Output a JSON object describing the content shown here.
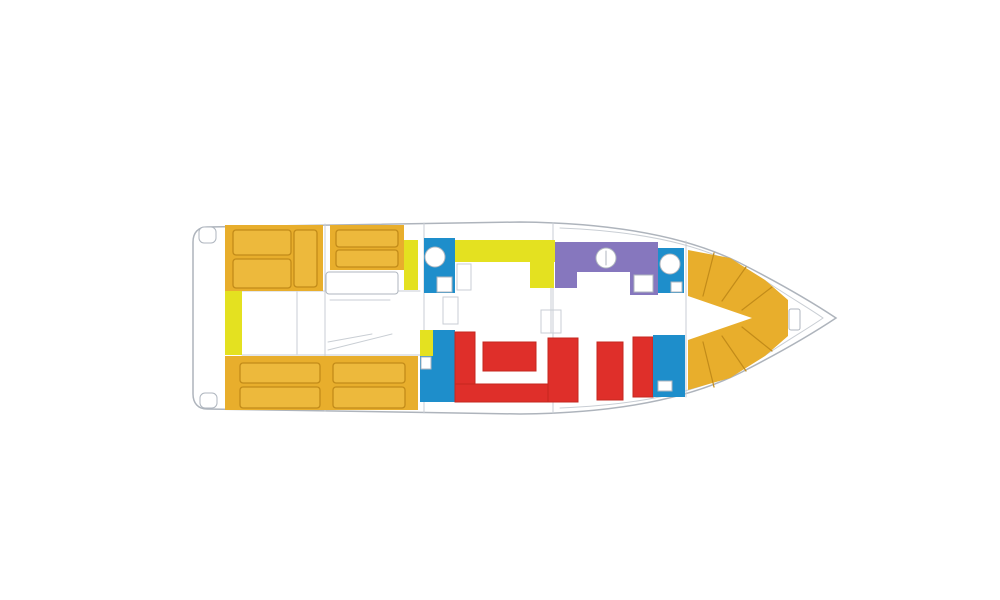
{
  "canvas": {
    "width": 1000,
    "height": 600,
    "background": "#FFFFFF"
  },
  "palette": {
    "white": "#FFFFFF",
    "amber": "#E8AE2C",
    "amber_light": "#EDB93C",
    "amber_stroke": "#C28B19",
    "lemon": "#E4E120",
    "blue": "#1E8ECB",
    "purple": "#8677BE",
    "red": "#DF2F2A",
    "red_stroke": "#C4271F",
    "hull_stroke": "#AEB4BC",
    "detail_stroke": "#AFB6BF",
    "detail_light": "#C9CED4"
  },
  "shapes": [
    {
      "type": "path",
      "name": "hull-outline",
      "d": "M207,227 L520,222 C620,223 690,238 740,263 C785,286 818,306 836,318 C818,330 785,350 740,373 C690,398 620,413 520,414 L207,409 C198,409 193,403 193,394 L193,242 C193,233 198,227 207,227 Z",
      "fill": "white",
      "stroke": "hull_stroke",
      "sw": 1.5
    },
    {
      "type": "path",
      "name": "hull-inner-line",
      "d": "M560,228 C660,232 716,250 761,278 C791,298 812,310 823,318 C812,326 791,338 761,358 C716,386 660,404 560,408",
      "fill": "none",
      "stroke": "detail_light",
      "sw": 1
    },
    {
      "type": "rect",
      "name": "stern-step-top",
      "x": 199,
      "y": 227,
      "w": 17,
      "h": 16,
      "rx": 5,
      "fill": "white",
      "stroke": "detail_stroke",
      "sw": 1
    },
    {
      "type": "rect",
      "name": "stern-step-bottom",
      "x": 200,
      "y": 393,
      "w": 17,
      "h": 15,
      "rx": 5,
      "fill": "white",
      "stroke": "detail_stroke",
      "sw": 1
    },
    {
      "type": "line",
      "name": "bulkhead-line",
      "x1": 325,
      "y1": 224,
      "x2": 325,
      "y2": 411,
      "stroke": "detail_light",
      "sw": 1
    },
    {
      "type": "line",
      "name": "bulkhead-line",
      "x1": 424,
      "y1": 223,
      "x2": 424,
      "y2": 413,
      "stroke": "detail_light",
      "sw": 1
    },
    {
      "type": "line",
      "name": "bulkhead-line",
      "x1": 553,
      "y1": 223,
      "x2": 553,
      "y2": 413,
      "stroke": "detail_light",
      "sw": 1
    },
    {
      "type": "line",
      "name": "bulkhead-line",
      "x1": 686,
      "y1": 241,
      "x2": 686,
      "y2": 397,
      "stroke": "detail_light",
      "sw": 1
    },
    {
      "type": "line",
      "name": "walkway-line",
      "x1": 242,
      "y1": 291,
      "x2": 420,
      "y2": 291,
      "stroke": "detail_light",
      "sw": 1
    },
    {
      "type": "line",
      "name": "walkway-line",
      "x1": 242,
      "y1": 355,
      "x2": 420,
      "y2": 355,
      "stroke": "detail_light",
      "sw": 1
    },
    {
      "type": "line",
      "name": "companionway-line",
      "x1": 297,
      "y1": 292,
      "x2": 297,
      "y2": 354,
      "stroke": "detail_light",
      "sw": 1
    },
    {
      "type": "rect",
      "name": "aft-sunpad-port",
      "x": 225,
      "y": 225,
      "w": 98,
      "h": 66,
      "fill": "amber"
    },
    {
      "type": "rect",
      "name": "aft-sunpad-mid",
      "x": 330,
      "y": 225,
      "w": 74,
      "h": 45,
      "fill": "amber"
    },
    {
      "type": "rect",
      "name": "aft-sunpad-starboard",
      "x": 225,
      "y": 356,
      "w": 193,
      "h": 54,
      "fill": "amber"
    },
    {
      "type": "rect",
      "name": "sunpad-cushion",
      "x": 233,
      "y": 230,
      "w": 58,
      "h": 25,
      "rx": 3,
      "fill": "amber_light",
      "stroke": "amber_stroke",
      "sw": 1.3
    },
    {
      "type": "rect",
      "name": "sunpad-cushion",
      "x": 233,
      "y": 259,
      "w": 58,
      "h": 29,
      "rx": 3,
      "fill": "amber_light",
      "stroke": "amber_stroke",
      "sw": 1.3
    },
    {
      "type": "rect",
      "name": "sunpad-cushion",
      "x": 294,
      "y": 230,
      "w": 23,
      "h": 57,
      "rx": 3,
      "fill": "amber_light",
      "stroke": "amber_stroke",
      "sw": 1.3
    },
    {
      "type": "rect",
      "name": "sunpad-cushion",
      "x": 336,
      "y": 230,
      "w": 62,
      "h": 17,
      "rx": 3,
      "fill": "amber_light",
      "stroke": "amber_stroke",
      "sw": 1.3
    },
    {
      "type": "rect",
      "name": "sunpad-cushion",
      "x": 336,
      "y": 250,
      "w": 62,
      "h": 17,
      "rx": 3,
      "fill": "amber_light",
      "stroke": "amber_stroke",
      "sw": 1.3
    },
    {
      "type": "rect",
      "name": "sunpad-cushion",
      "x": 240,
      "y": 363,
      "w": 80,
      "h": 20,
      "rx": 3,
      "fill": "amber_light",
      "stroke": "amber_stroke",
      "sw": 1.3
    },
    {
      "type": "rect",
      "name": "sunpad-cushion",
      "x": 240,
      "y": 387,
      "w": 80,
      "h": 21,
      "rx": 3,
      "fill": "amber_light",
      "stroke": "amber_stroke",
      "sw": 1.3
    },
    {
      "type": "rect",
      "name": "sunpad-cushion",
      "x": 333,
      "y": 363,
      "w": 72,
      "h": 20,
      "rx": 3,
      "fill": "amber_light",
      "stroke": "amber_stroke",
      "sw": 1.3
    },
    {
      "type": "rect",
      "name": "sunpad-cushion",
      "x": 333,
      "y": 387,
      "w": 72,
      "h": 21,
      "rx": 3,
      "fill": "amber_light",
      "stroke": "amber_stroke",
      "sw": 1.3
    },
    {
      "type": "rect",
      "name": "side-counter-strip",
      "x": 225,
      "y": 291,
      "w": 17,
      "h": 64,
      "fill": "lemon"
    },
    {
      "type": "rect",
      "name": "counter-strip-mid",
      "x": 404,
      "y": 240,
      "w": 14,
      "h": 50,
      "fill": "lemon"
    },
    {
      "type": "rect",
      "name": "berth-outline",
      "x": 326,
      "y": 272,
      "w": 72,
      "h": 22,
      "rx": 3,
      "fill": "white",
      "stroke": "detail_stroke",
      "sw": 1
    },
    {
      "type": "line",
      "name": "berth-line",
      "x1": 330,
      "y1": 300,
      "x2": 390,
      "y2": 300,
      "stroke": "detail_light",
      "sw": 1
    },
    {
      "type": "line",
      "name": "stair-line",
      "x1": 328,
      "y1": 350,
      "x2": 392,
      "y2": 334,
      "stroke": "detail_light",
      "sw": 1
    },
    {
      "type": "line",
      "name": "stair-line",
      "x1": 328,
      "y1": 342,
      "x2": 372,
      "y2": 334,
      "stroke": "detail_light",
      "sw": 1
    },
    {
      "type": "rect",
      "name": "wet-unit-top",
      "x": 424,
      "y": 238,
      "w": 31,
      "h": 55,
      "fill": "blue"
    },
    {
      "type": "circle",
      "name": "sink-basin",
      "cx": 435,
      "cy": 257,
      "r": 10,
      "fill": "white",
      "stroke": "detail_stroke",
      "sw": 1
    },
    {
      "type": "rect",
      "name": "fixture",
      "x": 437,
      "y": 277,
      "w": 15,
      "h": 15,
      "fill": "white",
      "stroke": "detail_stroke",
      "sw": 1
    },
    {
      "type": "rect",
      "name": "cabinet-outline",
      "x": 457,
      "y": 264,
      "w": 14,
      "h": 26,
      "fill": "none",
      "stroke": "detail_light",
      "sw": 1
    },
    {
      "type": "rect",
      "name": "galley-counter",
      "x": 455,
      "y": 240,
      "w": 100,
      "h": 22,
      "fill": "lemon"
    },
    {
      "type": "rect",
      "name": "galley-counter-return",
      "x": 530,
      "y": 262,
      "w": 24,
      "h": 26,
      "fill": "lemon"
    },
    {
      "type": "rect",
      "name": "helm-station",
      "x": 555,
      "y": 242,
      "w": 103,
      "h": 30,
      "fill": "purple"
    },
    {
      "type": "rect",
      "name": "helm-station-left",
      "x": 555,
      "y": 272,
      "w": 22,
      "h": 16,
      "fill": "purple"
    },
    {
      "type": "rect",
      "name": "helm-station-right",
      "x": 630,
      "y": 272,
      "w": 28,
      "h": 23,
      "fill": "purple"
    },
    {
      "type": "circle",
      "name": "helm-wheel",
      "cx": 606,
      "cy": 258,
      "r": 10,
      "fill": "white",
      "stroke": "detail_stroke",
      "sw": 1
    },
    {
      "type": "line",
      "name": "helm-wheel-mark",
      "x1": 606,
      "y1": 251,
      "x2": 606,
      "y2": 265,
      "stroke": "detail_stroke",
      "sw": 1
    },
    {
      "type": "rect",
      "name": "nav-table",
      "x": 634,
      "y": 275,
      "w": 19,
      "h": 17,
      "fill": "white",
      "stroke": "detail_stroke",
      "sw": 1
    },
    {
      "type": "rect",
      "name": "wet-unit-bow",
      "x": 658,
      "y": 248,
      "w": 26,
      "h": 45,
      "fill": "blue"
    },
    {
      "type": "circle",
      "name": "sink-basin-bow",
      "cx": 670,
      "cy": 264,
      "r": 10,
      "fill": "white",
      "stroke": "detail_stroke",
      "sw": 1
    },
    {
      "type": "rect",
      "name": "fixture-bow",
      "x": 671,
      "y": 282,
      "w": 11,
      "h": 10,
      "fill": "white",
      "stroke": "detail_stroke",
      "sw": 1
    },
    {
      "type": "rect",
      "name": "door-outline",
      "x": 443,
      "y": 297,
      "w": 15,
      "h": 27,
      "fill": "none",
      "stroke": "detail_light",
      "sw": 1
    },
    {
      "type": "rect",
      "name": "door-outline",
      "x": 541,
      "y": 310,
      "w": 20,
      "h": 23,
      "fill": "none",
      "stroke": "detail_light",
      "sw": 1
    },
    {
      "type": "line",
      "name": "door-line",
      "x1": 551,
      "y1": 288,
      "x2": 551,
      "y2": 333,
      "stroke": "detail_light",
      "sw": 1
    },
    {
      "type": "rect",
      "name": "wet-unit-salon",
      "x": 420,
      "y": 330,
      "w": 35,
      "h": 72,
      "fill": "blue"
    },
    {
      "type": "rect",
      "name": "counter-strip-lower",
      "x": 420,
      "y": 330,
      "w": 13,
      "h": 26,
      "fill": "lemon"
    },
    {
      "type": "rect",
      "name": "fixture-salon",
      "x": 421,
      "y": 357,
      "w": 10,
      "h": 12,
      "fill": "white",
      "stroke": "detail_stroke",
      "sw": 1
    },
    {
      "type": "rect",
      "name": "sofa-left-arm",
      "x": 455,
      "y": 332,
      "w": 20,
      "h": 70,
      "fill": "red",
      "stroke": "red_stroke",
      "sw": 1
    },
    {
      "type": "rect",
      "name": "sofa-bottom",
      "x": 455,
      "y": 384,
      "w": 123,
      "h": 18,
      "fill": "red",
      "stroke": "red_stroke",
      "sw": 1
    },
    {
      "type": "rect",
      "name": "sofa-right-arm",
      "x": 548,
      "y": 338,
      "w": 30,
      "h": 64,
      "fill": "red",
      "stroke": "red_stroke",
      "sw": 1
    },
    {
      "type": "rect",
      "name": "coffee-table",
      "x": 483,
      "y": 342,
      "w": 53,
      "h": 29,
      "fill": "red",
      "stroke": "red_stroke",
      "sw": 1
    },
    {
      "type": "rect",
      "name": "bench-seat",
      "x": 597,
      "y": 342,
      "w": 26,
      "h": 58,
      "fill": "red",
      "stroke": "red_stroke",
      "sw": 1
    },
    {
      "type": "rect",
      "name": "bench-seat-2",
      "x": 633,
      "y": 337,
      "w": 20,
      "h": 60,
      "fill": "red",
      "stroke": "red_stroke",
      "sw": 1
    },
    {
      "type": "rect",
      "name": "wet-unit-starboard",
      "x": 653,
      "y": 335,
      "w": 32,
      "h": 62,
      "fill": "blue"
    },
    {
      "type": "rect",
      "name": "fixture-starboard",
      "x": 658,
      "y": 381,
      "w": 14,
      "h": 10,
      "fill": "white",
      "stroke": "detail_stroke",
      "sw": 1
    },
    {
      "type": "polygon",
      "name": "bow-seating",
      "points": "688,250 730,258 765,280 788,300 788,336 765,356 730,378 688,390 688,340 752,318 688,296",
      "fill": "amber"
    },
    {
      "type": "line",
      "name": "bow-seam",
      "x1": 714,
      "y1": 253,
      "x2": 703,
      "y2": 296,
      "stroke": "amber_stroke",
      "sw": 1.2
    },
    {
      "type": "line",
      "name": "bow-seam",
      "x1": 746,
      "y1": 267,
      "x2": 722,
      "y2": 301,
      "stroke": "amber_stroke",
      "sw": 1.2
    },
    {
      "type": "line",
      "name": "bow-seam",
      "x1": 772,
      "y1": 287,
      "x2": 742,
      "y2": 310,
      "stroke": "amber_stroke",
      "sw": 1.2
    },
    {
      "type": "line",
      "name": "bow-seam",
      "x1": 714,
      "y1": 387,
      "x2": 703,
      "y2": 342,
      "stroke": "amber_stroke",
      "sw": 1.2
    },
    {
      "type": "line",
      "name": "bow-seam",
      "x1": 746,
      "y1": 371,
      "x2": 722,
      "y2": 336,
      "stroke": "amber_stroke",
      "sw": 1.2
    },
    {
      "type": "line",
      "name": "bow-seam",
      "x1": 772,
      "y1": 351,
      "x2": 742,
      "y2": 327,
      "stroke": "amber_stroke",
      "sw": 1.2
    },
    {
      "type": "rect",
      "name": "bow-hatch",
      "x": 789,
      "y": 309,
      "w": 11,
      "h": 21,
      "rx": 2,
      "fill": "white",
      "stroke": "detail_stroke",
      "sw": 1
    }
  ]
}
